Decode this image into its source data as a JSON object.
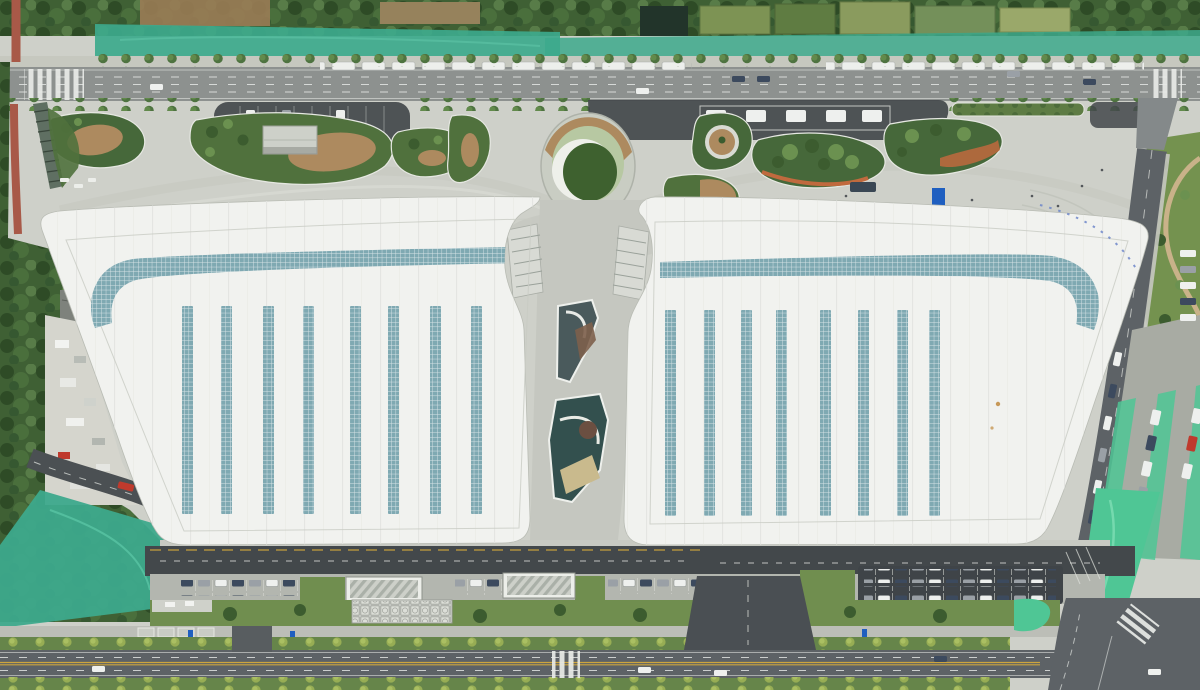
{
  "scene": {
    "type": "aerial-photograph",
    "description": "Top-down drone view of a twin-roof transit hub complex with plaza, landscaped islands, roads, parking and construction areas"
  },
  "palette": {
    "plaza": "#ced0c9",
    "canyon": "#c5c7c0",
    "roof_white": "#f1f2ef",
    "roof_seam": "#e2e4e0",
    "roof_edge": "#b9bcb4",
    "teal_panel": "#7fa9b2",
    "asphalt_dark": "#43484b",
    "asphalt_mid": "#5d6266",
    "road_top": "#8d918f",
    "lane_white": "#e9ebe8",
    "lane_yellow": "#d3a93c",
    "grass": "#50713d",
    "grass_dark": "#46683a",
    "lawn": "#708e4f",
    "lawn_dark": "#3e612f",
    "forest": "#3c5c31",
    "mulch": "#ad8a5f",
    "dirt": "#9a7c55",
    "net_teal": "#3da98c",
    "net_bright": "#4fc695",
    "red_path": "#a85948",
    "orange_path": "#c06a3e",
    "blue_accent": "#1f5fc0",
    "truck_red": "#bf3a2d",
    "car_white": "#eef0ee",
    "car_dark": "#3c4a5e",
    "car_gray": "#9aa0a6"
  },
  "roofs": {
    "skylight_stripes_per_roof": 8,
    "left": {
      "stripe_xs": [
        182,
        221,
        263,
        303,
        350,
        388,
        430,
        471
      ],
      "stripe_y": 306,
      "stripe_h": 208,
      "stripe_w": 11
    },
    "right": {
      "stripe_xs": [
        665,
        704,
        741,
        776,
        820,
        858,
        897,
        929
      ],
      "stripe_y": 310,
      "stripe_h": 206,
      "stripe_w": 11
    }
  },
  "vehicles": {
    "moving": [
      {
        "x": 732,
        "y": 76,
        "c": "car_dark"
      },
      {
        "x": 757,
        "y": 76,
        "c": "car_dark"
      },
      {
        "x": 1007,
        "y": 71,
        "c": "car_gray"
      },
      {
        "x": 1083,
        "y": 79,
        "c": "car_dark"
      },
      {
        "x": 636,
        "y": 88,
        "c": "car_white"
      },
      {
        "x": 150,
        "y": 84,
        "c": "car_white"
      },
      {
        "x": 92,
        "y": 666,
        "c": "car_white"
      },
      {
        "x": 638,
        "y": 667,
        "c": "car_white"
      },
      {
        "x": 714,
        "y": 670,
        "c": "car_white"
      },
      {
        "x": 934,
        "y": 656,
        "c": "car_dark"
      },
      {
        "x": 1148,
        "y": 669,
        "c": "car_white"
      }
    ]
  },
  "plaza": {
    "people": [
      [
        586,
        242
      ],
      [
        602,
        238
      ],
      [
        625,
        212
      ],
      [
        648,
        225
      ],
      [
        700,
        212
      ],
      [
        726,
        206
      ],
      [
        762,
        200
      ],
      [
        788,
        212
      ],
      [
        820,
        206
      ],
      [
        846,
        196
      ],
      [
        872,
        210
      ],
      [
        906,
        214
      ],
      [
        942,
        208
      ],
      [
        972,
        200
      ],
      [
        1002,
        212
      ],
      [
        1032,
        196
      ],
      [
        1058,
        206
      ],
      [
        1082,
        186
      ],
      [
        1102,
        170
      ],
      [
        510,
        208
      ],
      [
        470,
        206
      ],
      [
        430,
        212
      ],
      [
        380,
        205
      ],
      [
        340,
        208
      ],
      [
        300,
        210
      ]
    ]
  }
}
